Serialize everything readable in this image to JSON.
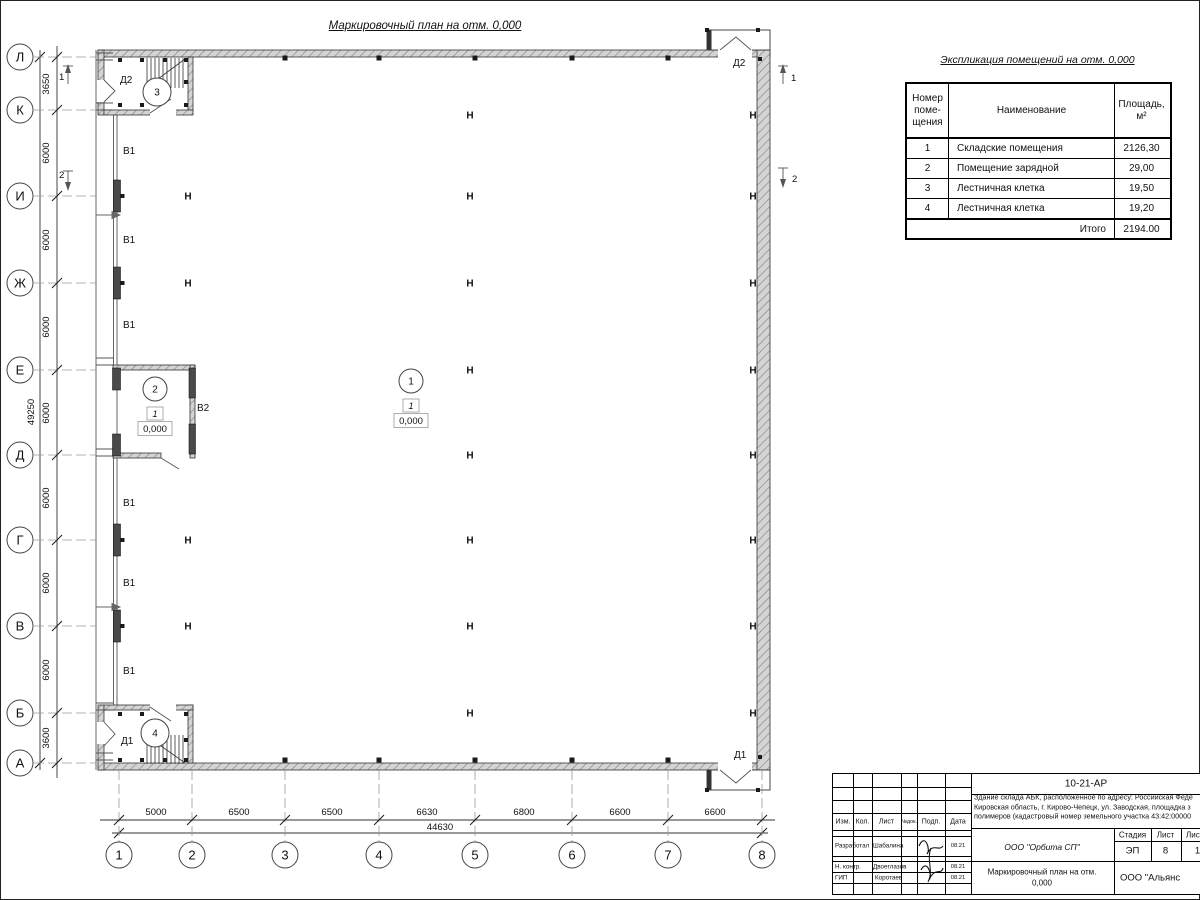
{
  "page": {
    "plan_title": "Маркировочный план на отм. 0,000"
  },
  "table": {
    "title": "Экспликация помещений на отм. 0,000",
    "header_number": "Номер\nпоме-\nщения",
    "header_name": "Наименование",
    "header_area": "Площадь,\nм²",
    "rows": [
      [
        "1",
        "Складские помещения",
        "2126,30"
      ],
      [
        "2",
        "Помещение зарядной",
        "29,00"
      ],
      [
        "3",
        "Лестничная клетка",
        "19,50"
      ],
      [
        "4",
        "Лестничная клетка",
        "19,20"
      ]
    ],
    "total_label": "Итого",
    "total_value": "2194.00"
  },
  "plan": {
    "row_axes": [
      {
        "label": "Л",
        "y": 57
      },
      {
        "label": "К",
        "y": 110
      },
      {
        "label": "И",
        "y": 196
      },
      {
        "label": "Ж",
        "y": 283
      },
      {
        "label": "Е",
        "y": 370
      },
      {
        "label": "Д",
        "y": 455
      },
      {
        "label": "Г",
        "y": 540
      },
      {
        "label": "В",
        "y": 626
      },
      {
        "label": "Б",
        "y": 713
      },
      {
        "label": "А",
        "y": 763
      }
    ],
    "col_axes": [
      {
        "label": "1",
        "x": 119
      },
      {
        "label": "2",
        "x": 192
      },
      {
        "label": "3",
        "x": 285
      },
      {
        "label": "4",
        "x": 379
      },
      {
        "label": "5",
        "x": 475
      },
      {
        "label": "6",
        "x": 572
      },
      {
        "label": "7",
        "x": 668
      },
      {
        "label": "8",
        "x": 762
      }
    ],
    "left_dims": [
      {
        "text": "3650",
        "y": 84
      },
      {
        "text": "6000",
        "y": 153
      },
      {
        "text": "6000",
        "y": 240
      },
      {
        "text": "6000",
        "y": 327
      },
      {
        "text": "6000",
        "y": 413
      },
      {
        "text": "6000",
        "y": 498
      },
      {
        "text": "6000",
        "y": 583
      },
      {
        "text": "6000",
        "y": 670
      },
      {
        "text": "3600",
        "y": 738
      }
    ],
    "left_total": "49250",
    "bottom_dims": [
      {
        "text": "5000",
        "x": 156
      },
      {
        "text": "6500",
        "x": 239
      },
      {
        "text": "6500",
        "x": 332
      },
      {
        "text": "6630",
        "x": 427
      },
      {
        "text": "6800",
        "x": 524
      },
      {
        "text": "6600",
        "x": 620
      },
      {
        "text": "6600",
        "x": 715
      }
    ],
    "bottom_total": "44630",
    "column_mark": "Н",
    "column_marks": [
      [
        470,
        115
      ],
      [
        753,
        115
      ],
      [
        188,
        196
      ],
      [
        470,
        196
      ],
      [
        753,
        196
      ],
      [
        188,
        283
      ],
      [
        470,
        283
      ],
      [
        753,
        283
      ],
      [
        470,
        370
      ],
      [
        753,
        370
      ],
      [
        470,
        455
      ],
      [
        753,
        455
      ],
      [
        188,
        540
      ],
      [
        470,
        540
      ],
      [
        753,
        540
      ],
      [
        188,
        626
      ],
      [
        470,
        626
      ],
      [
        753,
        626
      ],
      [
        470,
        713
      ],
      [
        753,
        713
      ]
    ],
    "gate_labels": [
      {
        "text": "В1",
        "x": 123,
        "y": 154
      },
      {
        "text": "В1",
        "x": 123,
        "y": 243
      },
      {
        "text": "В1",
        "x": 123,
        "y": 328
      },
      {
        "text": "В1",
        "x": 123,
        "y": 506
      },
      {
        "text": "В1",
        "x": 123,
        "y": 586
      },
      {
        "text": "В1",
        "x": 123,
        "y": 674
      },
      {
        "text": "В2",
        "x": 197,
        "y": 411
      }
    ],
    "door_labels": [
      {
        "text": "Д2",
        "x": 120,
        "y": 83
      },
      {
        "text": "Д2",
        "x": 733,
        "y": 66
      },
      {
        "text": "Д1",
        "x": 121,
        "y": 744
      },
      {
        "text": "Д1",
        "x": 734,
        "y": 758
      }
    ],
    "room_markers": [
      {
        "num": "1",
        "cx": 411,
        "cy": 381,
        "r": 12,
        "zone": "1",
        "level": "0,000"
      },
      {
        "num": "2",
        "cx": 155,
        "cy": 389,
        "r": 12,
        "zone": "1",
        "level": "0,000"
      },
      {
        "num": "3",
        "cx": 157,
        "cy": 92,
        "r": 14
      },
      {
        "num": "4",
        "cx": 155,
        "cy": 733,
        "r": 14
      }
    ],
    "section_marks": [
      {
        "label": "1",
        "x": 68,
        "y1": 66,
        "y2": 84,
        "dir": "up",
        "tx": 59,
        "ty": 80
      },
      {
        "label": "2",
        "x": 68,
        "y1": 171,
        "y2": 189,
        "dir": "down",
        "tx": 59,
        "ty": 178
      },
      {
        "label": "1",
        "x": 783,
        "y1": 66,
        "y2": 84,
        "dir": "up",
        "tx": 791,
        "ty": 81
      },
      {
        "label": "2",
        "x": 783,
        "y1": 168,
        "y2": 186,
        "dir": "down",
        "tx": 792,
        "ty": 182
      }
    ]
  },
  "titleblock": {
    "doc_number": "10-21-АР",
    "desc_line1": "Здание склада АБК, расположенное по адресу: Российская Феде",
    "desc_line2": "Кировская область, г. Кирово-Чепецк, ул. Заводская, площадка з",
    "desc_line3": "полимеров (кадастровый номер земельного участка 43:42:00000",
    "col_izm": "Изм.",
    "col_kol": "Кол.",
    "col_list": "Лист",
    "col_ndok": "№док.",
    "col_podp": "Подп.",
    "col_data": "Дата",
    "role1": "Разработал",
    "name1": "Шабалина",
    "date1": "08.21",
    "role2": "Н. контр.",
    "name2": "Двоеглазов",
    "date2": "08.21",
    "role3": "ГИП",
    "name3": "Коротаев",
    "date3": "08.21",
    "org": "ООО \"Орбита СП\"",
    "stage_label": "Стадия",
    "sheet_label": "Лист",
    "sheets_label": "Листов",
    "stage": "ЭП",
    "sheet_no": "8",
    "sheets_total": "1",
    "drawing_name1": "Маркировочный план на отм.",
    "drawing_name2": "0,000",
    "company": "ООО \"Альянс"
  }
}
